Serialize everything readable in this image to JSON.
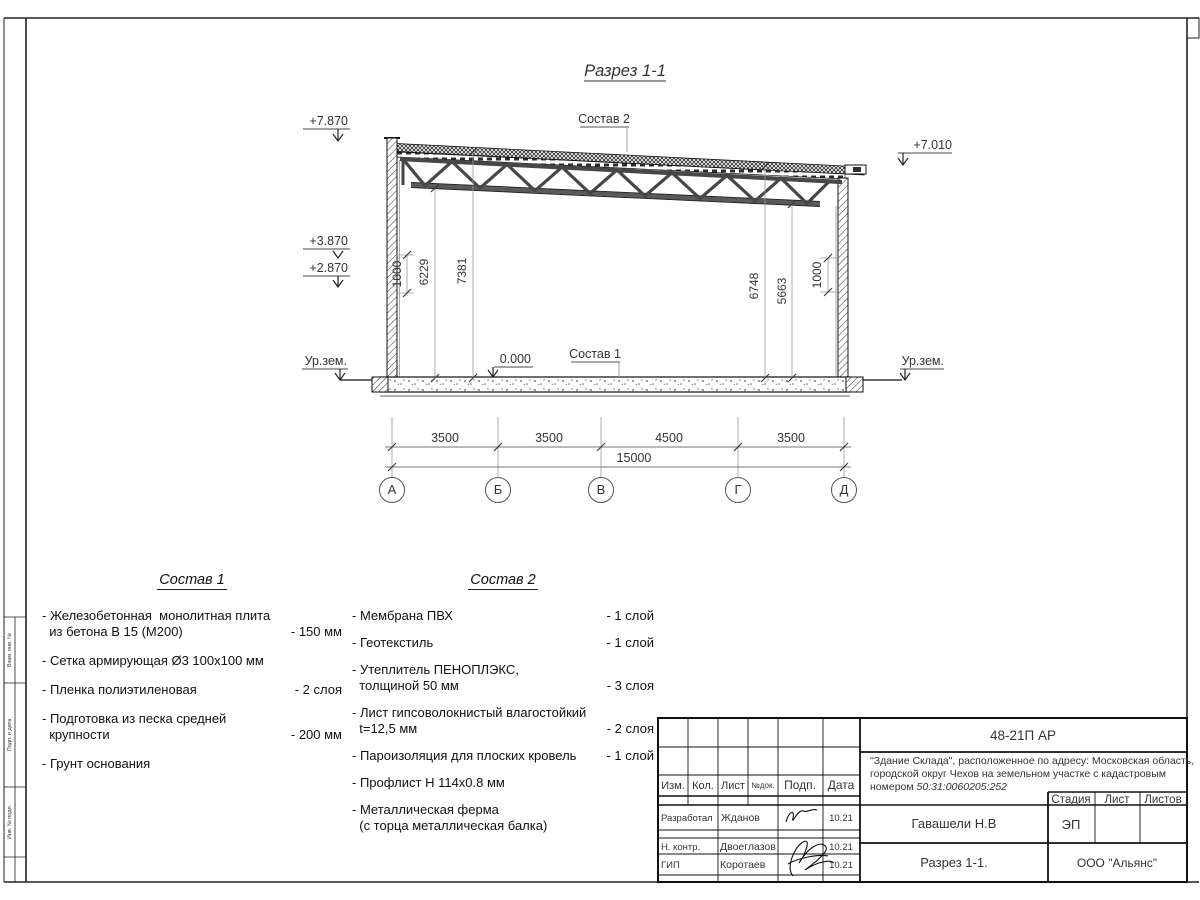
{
  "sheet": {
    "title": "Разрез 1-1"
  },
  "drawing": {
    "composition1_ref": "Состав 1",
    "composition2_ref": "Состав 2",
    "elev_left_top": "+7.870",
    "elev_left_mid": "+3.870",
    "elev_left_low": "+2.870",
    "elev_right": "+7.010",
    "elev_zero": "0.000",
    "ground_left": "Ур.зем.",
    "ground_right": "Ур.зем.",
    "vdim_left_wall": "1000",
    "vdim_left_a": "6229",
    "vdim_left_b": "7381",
    "vdim_right_a": "6748",
    "vdim_right_b": "5663",
    "vdim_right_wall": "1000",
    "spans": [
      "3500",
      "3500",
      "4500",
      "3500"
    ],
    "total_span": "15000",
    "axes": [
      "А",
      "Б",
      "В",
      "Г",
      "Д"
    ]
  },
  "sostav1": {
    "title": "Состав 1",
    "items": [
      {
        "name": "- Железобетонная  монолитная плита\n  из бетона В 15 (М200)",
        "value": "- 150 мм"
      },
      {
        "name": "- Сетка армирующая Ø3 100х100 мм",
        "value": ""
      },
      {
        "name": "- Пленка полиэтиленовая",
        "value": "-  2 слоя"
      },
      {
        "name": "- Подготовка из песка средней\n  крупности",
        "value": "- 200 мм"
      },
      {
        "name": "- Грунт основания",
        "value": ""
      }
    ]
  },
  "sostav2": {
    "title": "Состав 2",
    "items": [
      {
        "name": "- Мембрана ПВХ",
        "value": "- 1 слой"
      },
      {
        "name": "- Геотекстиль",
        "value": "- 1 слой"
      },
      {
        "name": "- Утеплитель ПЕНОПЛЭКС,\n  толщиной 50 мм",
        "value": "- 3 слоя"
      },
      {
        "name": "- Лист гипсоволокнистый влагостойкий\n  t=12,5 мм",
        "value": "- 2 слоя"
      },
      {
        "name": "- Пароизоляция для плоских кровель",
        "value": "- 1 слой"
      },
      {
        "name": "- Профлист Н 114х0.8 мм",
        "value": ""
      },
      {
        "name": "- Металлическая ферма\n  (с торца металлическая балка)",
        "value": ""
      }
    ]
  },
  "titleblock": {
    "doc_number": "48-21П АР",
    "desc_line1": "\"Здание Склада\", расположенное по адресу: Московская область,",
    "desc_line2": "городской округ Чехов на земельном участке с кадастровым",
    "desc_line3_prefix": "номером ",
    "cadastral": "50:31:0060205:252",
    "col_izm": "Изм.",
    "col_kol": "Кол.",
    "col_list": "Лист",
    "col_doc": "№док.",
    "col_podp": "Подп.",
    "col_data": "Дата",
    "row1_role": "Разработал",
    "row1_name": "Жданов",
    "row1_date": "10.21",
    "row2_role": "Н. контр.",
    "row2_name": "Двоеглазов",
    "row2_date": "10.21",
    "row3_role": "ГИП",
    "row3_name": "Коротаев",
    "row3_date": "10.21",
    "chief": "Гавашели Н.В",
    "stage_label": "Стадия",
    "list_label": "Лист",
    "listov_label": "Листов",
    "stage_value": "ЭП",
    "drawing_name": "Разрез 1-1.",
    "company": "ООО \"Альянс\""
  },
  "frame": {
    "side_label_top": "Взам. инв. №",
    "side_label_mid": "Подп. и дата",
    "side_label_bottom": "Инв. № подл."
  }
}
